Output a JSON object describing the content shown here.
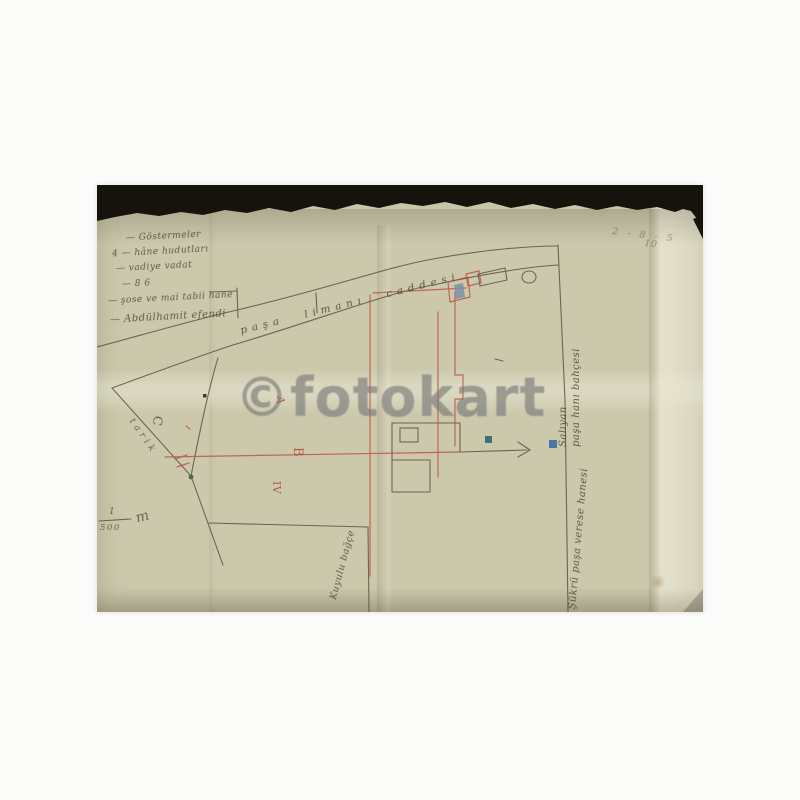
{
  "document": {
    "legend_items": [
      "—   Göstermeler",
      "4 —  hâne hudutları",
      "—  vadiye vadat",
      "—  8 6",
      "— şose ve mai tabii hane",
      "— Abdülhamit efendi"
    ],
    "road_label": "paşa limanı caddesi",
    "plot_labels": {
      "tarik": "tarik",
      "c": "C",
      "a": "A",
      "b": "B",
      "iv": "IV"
    },
    "scale": {
      "numerator": "1",
      "denominator": "500",
      "unit": "m"
    },
    "corner_note": {
      "line1": "2 - 8 - 5",
      "line2": "10"
    },
    "annotations": {
      "right_upper_line1": "Salıyan",
      "right_upper_line2": "paşa hanı bahçesi",
      "right_lower": "Şükrü paşa verese hanesi",
      "bottom": "Kuyulu bağçe"
    },
    "watermark": "©fotokart"
  },
  "colors": {
    "paper": "#ccc8ac",
    "pencil_ink": "#5a5444",
    "red_ink": "#b94f3c",
    "blue_dot": "#3d6d9e",
    "teal_dot": "#2c6a70",
    "green_dot": "#4c6b46",
    "watermark_gray": "#767676",
    "torn_edge_black": "#16130d"
  }
}
